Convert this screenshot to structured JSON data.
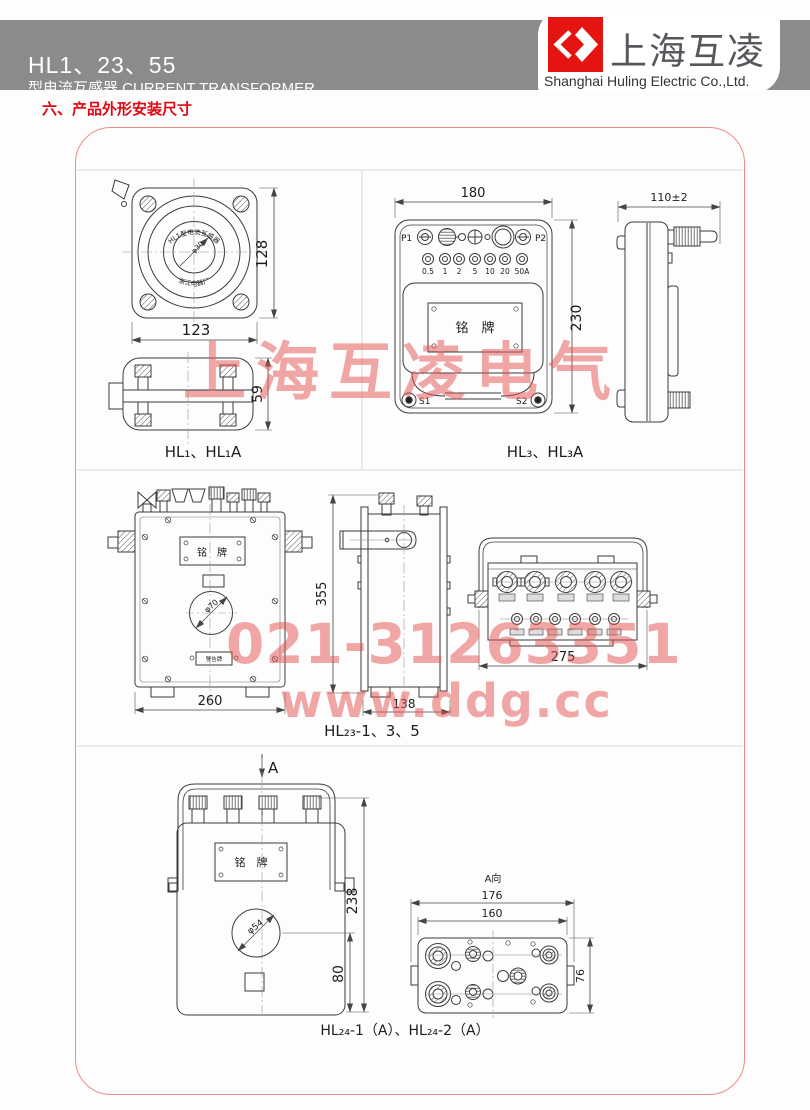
{
  "header": {
    "model": "HL1、23、55",
    "subtitle": "型电流互感器 CURRENT TRANSFORMER",
    "brand": "上海互凌",
    "company": "Shanghai Huling Electric Co.,Ltd."
  },
  "section_title": "六、产品外形安装尺寸",
  "watermark": {
    "line1": "上海互凌电气",
    "line2": "021-31263351",
    "line3": "www.ddg.cc"
  },
  "hl1": {
    "caption": "HL₁、HL₁A",
    "dim_width": "123",
    "dim_height": "128",
    "dim_depth": "59",
    "arc_top": "HL1型电流互感器",
    "arc_bottom": "浙江电器厂",
    "bore": "φ30"
  },
  "hl3": {
    "caption": "HL₃、HL₃A",
    "dim_width": "180",
    "dim_height": "230",
    "dim_depth": "110±2",
    "p1": "P1",
    "p2": "P2",
    "s1": "S1",
    "s2": "S2",
    "taps": [
      "0.5",
      "1",
      "2",
      "5",
      "10",
      "20",
      "50A"
    ],
    "nameplate": "铭　牌"
  },
  "hl23": {
    "caption": "HL₂₃-1、3、5",
    "dim_width": "260",
    "dim_height": "355",
    "dim_depth": "138",
    "dim_top_view": "275",
    "bore": "φ70",
    "nameplate": "铭　牌",
    "warning": "警告牌"
  },
  "hl24": {
    "caption": "HL₂₄-1（A）、HL₂₄-2（A）",
    "view_arrow": "A",
    "view_label": "A向",
    "dim_height": "238",
    "dim_lower": "80",
    "dim_outer_width": "176",
    "dim_inner_width": "160",
    "dim_side": "76",
    "bore": "φ54",
    "nameplate": "铭　牌"
  }
}
